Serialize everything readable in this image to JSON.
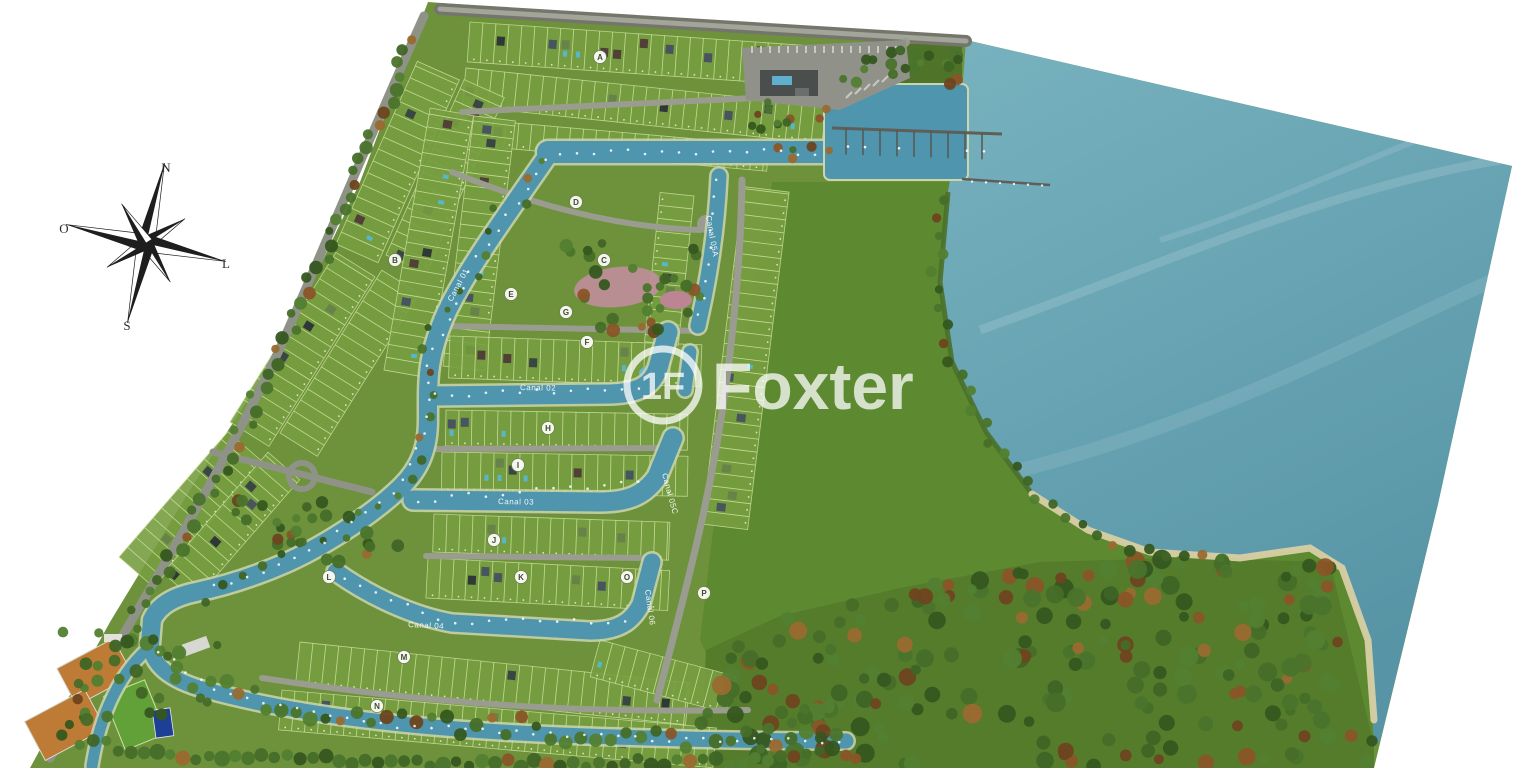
{
  "page": {
    "background": "#ffffff"
  },
  "compass": {
    "labels": {
      "north": "N",
      "south": "S",
      "west": "O",
      "east": "L"
    }
  },
  "watermark": {
    "brand": "Foxter",
    "monogram": "1F"
  },
  "map": {
    "canal_labels": [
      {
        "text": "Canal 01",
        "x": 452,
        "y": 302,
        "rotate": -62
      },
      {
        "text": "Canal 02",
        "x": 520,
        "y": 390,
        "rotate": 1
      },
      {
        "text": "Canal 03",
        "x": 498,
        "y": 504,
        "rotate": 1
      },
      {
        "text": "Canal 04",
        "x": 408,
        "y": 627,
        "rotate": 3
      },
      {
        "text": "Canal 05A",
        "x": 706,
        "y": 216,
        "rotate": 80
      },
      {
        "text": "Canal 05C",
        "x": 662,
        "y": 474,
        "rotate": 75
      },
      {
        "text": "Canal 06",
        "x": 645,
        "y": 590,
        "rotate": 82
      }
    ],
    "block_markers": [
      {
        "letter": "A",
        "x": 600,
        "y": 57
      },
      {
        "letter": "B",
        "x": 395,
        "y": 260
      },
      {
        "letter": "C",
        "x": 604,
        "y": 260
      },
      {
        "letter": "D",
        "x": 576,
        "y": 202
      },
      {
        "letter": "E",
        "x": 511,
        "y": 294
      },
      {
        "letter": "F",
        "x": 587,
        "y": 342
      },
      {
        "letter": "G",
        "x": 566,
        "y": 312
      },
      {
        "letter": "H",
        "x": 548,
        "y": 428
      },
      {
        "letter": "I",
        "x": 518,
        "y": 465
      },
      {
        "letter": "J",
        "x": 494,
        "y": 540
      },
      {
        "letter": "K",
        "x": 521,
        "y": 577
      },
      {
        "letter": "L",
        "x": 329,
        "y": 577
      },
      {
        "letter": "M",
        "x": 404,
        "y": 657
      },
      {
        "letter": "N",
        "x": 377,
        "y": 706
      },
      {
        "letter": "O",
        "x": 627,
        "y": 577
      },
      {
        "letter": "P",
        "x": 704,
        "y": 593
      }
    ],
    "colors": {
      "water": "#5e9cab",
      "water_light": "#74b0bd",
      "canal": "#4e95ad",
      "land": "#6e923c",
      "meadow": "#5d8a31",
      "forest": "#547c2b",
      "road": "#8f9287",
      "road_dark": "#74766c",
      "sand": "#d8cfa4",
      "court": "#bd7b36",
      "field": "#61a138",
      "pool": "#1e3f96"
    }
  }
}
